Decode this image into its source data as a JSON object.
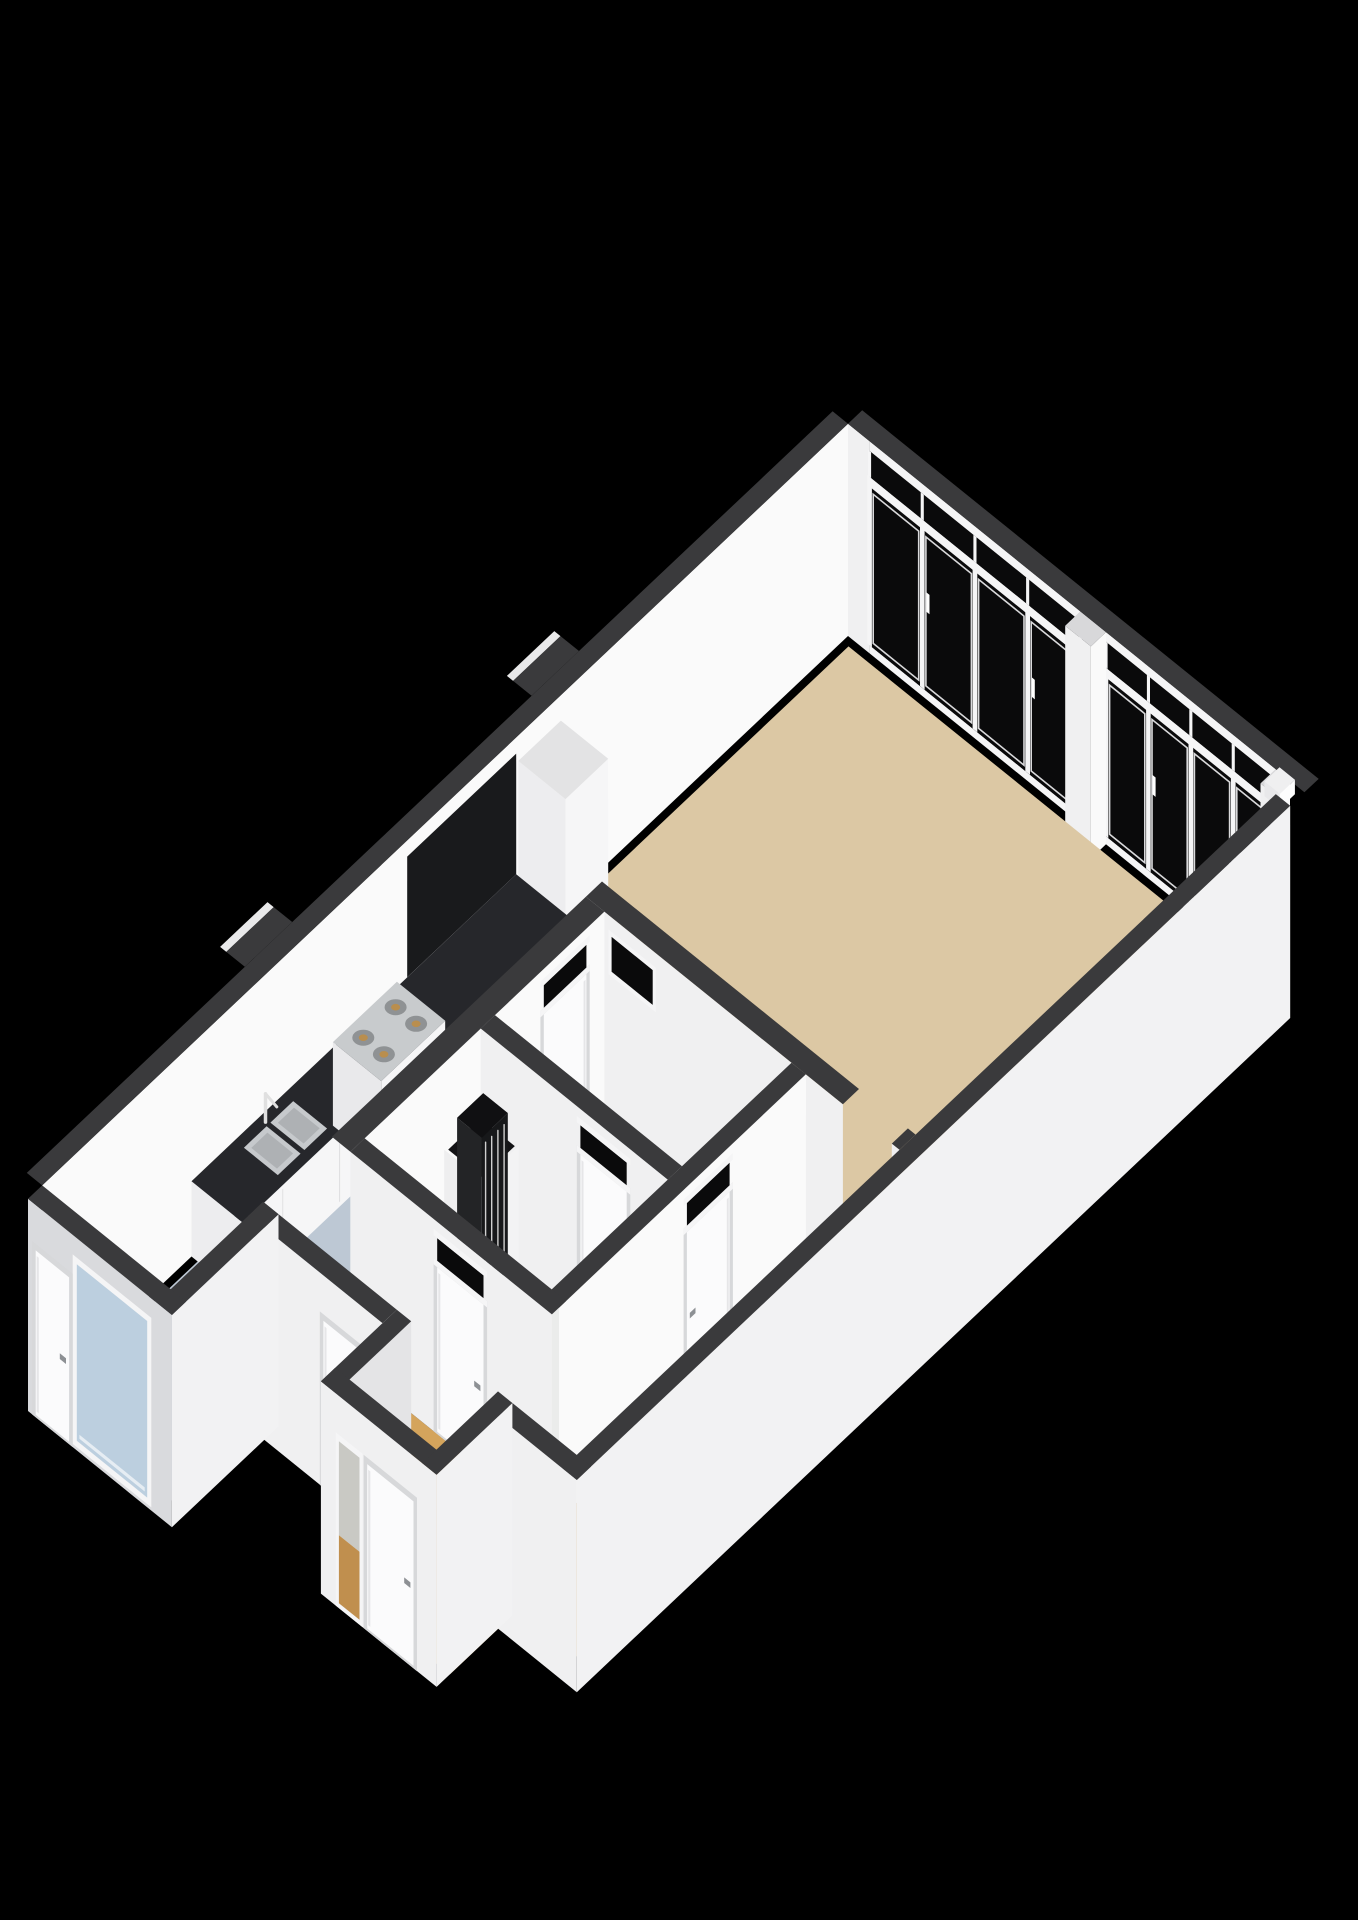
{
  "view": {
    "name": "3d-floorplan-render",
    "description": "Isometric 3D floor plan of an apartment on a black background"
  },
  "scene": {
    "canvas": {
      "width": 1358,
      "height": 1920,
      "background": "#000000"
    },
    "projection": {
      "origin": [
        848,
        636
      ],
      "u": [
        51.4,
        41.5
      ],
      "v": [
        -47.4,
        44.8
      ],
      "z": 81,
      "wallHeight": 2.62
    },
    "colors": {
      "wallTop": "#3a3a3c",
      "wallFaceU": "#fafafa",
      "wallFaceV": "#f0f0f1",
      "wallExtA": "#f2f2f3",
      "wallExtB": "#d9dadd",
      "wallShaded": "#e4e4e6",
      "bumpEdge": "#e9e9ea",
      "floorLiving": "#dcc8a4",
      "floorKitchen": "#bdc8d4",
      "floorHall": "#9aa0a8",
      "floorBath": "#ebeceb",
      "floorCorridor": "#d4a45c",
      "glassDark": "#0a0a0b",
      "glassBlue": "#bccfdf",
      "frame": "#f5f5f6",
      "frameShade": "#d7d8da",
      "paneLine": "#d9d9db",
      "counterTop": "#26272b",
      "counterSeam": "#dedee0",
      "cabinet": "#f6f6f7",
      "cabinetTop": "#e3e3e4",
      "backsplash": "#191a1c",
      "steel": "#c8cbcd",
      "burner": "#8f9294",
      "burnerCenter": "#b98e4e",
      "knob": "#6a6d70",
      "sinkSteel": "#c6c9cc",
      "sinkInner": "#aeb1b4",
      "faucet": "#e0e0e0",
      "radiator": "#1a1b1d",
      "radiatorSlat": "#cfcfcf",
      "shaftDark": "#141416",
      "stepWhite": "#f4f4f5",
      "doorLeaf": "#fbfbfc",
      "doorShade": "#e6e6e8",
      "handle": "#8d9094",
      "sidelightTop": "#c9c9c4",
      "sidelightBottom": "#c08f4e",
      "railing": "#f5f5f6"
    },
    "rooms": [
      {
        "name": "living-room",
        "floorColor": "floorLiving"
      },
      {
        "name": "kitchen",
        "floorColor": "floorKitchen"
      },
      {
        "name": "hall",
        "floorColor": "floorHall"
      },
      {
        "name": "bathroom",
        "floorColor": "floorBath"
      },
      {
        "name": "entrance-corridor",
        "floorColor": "floorCorridor"
      },
      {
        "name": "entry-alcove",
        "floorColor": "floorCorridor"
      }
    ],
    "floors": [
      {
        "name": "living-room-floor",
        "u": [
          0.12,
          8.48
        ],
        "v": [
          0.12,
          7.9
        ],
        "color": "floorLiving"
      },
      {
        "name": "kitchen-floor",
        "u": [
          0.12,
          2.5
        ],
        "v": [
          7.9,
          17.02
        ],
        "color": "floorKitchen"
      },
      {
        "name": "hall-floor",
        "u": [
          2.86,
          6.5
        ],
        "v": [
          8.24,
          10.57
        ],
        "color": "floorHall"
      },
      {
        "name": "bathroom-floor",
        "u": [
          2.86,
          6.5
        ],
        "v": [
          10.85,
          13.32
        ],
        "color": "floorBath"
      },
      {
        "name": "corridor-floor",
        "u": [
          6.78,
          8.48
        ],
        "v": [
          8.24,
          15.07
        ],
        "color": "floorCorridor"
      },
      {
        "name": "south-corridor-floor",
        "u": [
          2.86,
          6.78
        ],
        "v": [
          13.6,
          15.07
        ],
        "color": "floorCorridor"
      },
      {
        "name": "entry-alcove-floor",
        "u": [
          5.1,
          7.35
        ],
        "v": [
          15.05,
          16.37
        ],
        "color": "floorCorridor"
      }
    ],
    "nwWall": {
      "v": [
        0,
        17.0
      ],
      "band": [
        -0.3,
        0
      ],
      "bumps": [
        {
          "v": [
            5.35,
            6.35
          ]
        },
        {
          "v": [
            11.4,
            12.4
          ]
        }
      ]
    },
    "windowWall": {
      "solid": [
        0,
        0.42
      ],
      "banks": [
        {
          "u": [
            0.42,
            4.52
          ],
          "panes": 4
        },
        {
          "u": [
            5.02,
            8.32
          ],
          "panes": 4
        }
      ],
      "pillar": [
        4.52,
        5.02
      ],
      "post": [
        8.32,
        8.6
      ],
      "sill": 0.1,
      "glassTop": 2.06,
      "railTop": 2.18,
      "transomTop": 2.5,
      "headerTop": 2.62,
      "band": [
        -0.3,
        0
      ],
      "cap": {
        "u": [
          8.34,
          8.64
        ],
        "v": [
          -0.06,
          0.26
        ],
        "z": [
          2.44,
          2.62
        ]
      }
    },
    "interiorWalls": [
      {
        "name": "living-divider-wall",
        "axis": "u",
        "at": 7.9,
        "th": 0.34,
        "range": [
          2.5,
          8.6
        ],
        "openings": [
          [
            7.5,
            8.45
          ]
        ],
        "highWindow": {
          "range": [
            3.0,
            3.8
          ],
          "z": [
            1.95,
            2.38
          ]
        }
      },
      {
        "name": "kitchen-hall-wall",
        "axis": "v",
        "at": 2.5,
        "th": 0.36,
        "range": [
          8.24,
          13.6
        ],
        "door": {
          "range": [
            8.62,
            9.52
          ],
          "transom": true
        }
      },
      {
        "name": "hall-bathroom-wall",
        "axis": "u",
        "at": 10.55,
        "th": 0.3,
        "range": [
          2.86,
          6.5
        ],
        "door": {
          "range": [
            4.8,
            5.7
          ],
          "transom": true
        }
      },
      {
        "name": "hall-corridor-wall",
        "axis": "v",
        "at": 6.5,
        "th": 0.28,
        "range": [
          8.24,
          13.45
        ],
        "door": {
          "range": [
            9.85,
            10.75
          ],
          "transom": true
        }
      },
      {
        "name": "bathroom-south-wall",
        "axis": "u",
        "at": 13.3,
        "th": 0.3,
        "range": [
          2.86,
          6.78
        ],
        "door": {
          "range": [
            4.55,
            5.45
          ],
          "transom": true
        }
      }
    ],
    "exteriorWalls": [
      {
        "name": "se-exterior-wall",
        "axis": "v",
        "at": 8.6,
        "th": 0.28,
        "range": [
          0.3,
          15.35
        ],
        "faceColor": "wallExtA"
      },
      {
        "name": "south-wall-west",
        "axis": "u",
        "at": 15.05,
        "th": 0.3,
        "range": [
          2.5,
          5.1
        ],
        "door": {
          "range": [
            3.95,
            4.7
          ]
        },
        "faceColor": "wallFaceV"
      },
      {
        "name": "south-wall-east",
        "axis": "u",
        "at": 15.05,
        "th": 0.3,
        "range": [
          7.35,
          8.88
        ],
        "faceColor": "wallFaceV"
      },
      {
        "name": "alcove-west-wall",
        "axis": "v",
        "at": 5.1,
        "th": 0.28,
        "range": [
          15.05,
          16.65
        ],
        "faceColor": "wallShaded"
      },
      {
        "name": "alcove-front-wall",
        "axis": "u",
        "at": 16.35,
        "th": 0.3,
        "range": [
          5.1,
          7.35
        ],
        "door": {
          "range": [
            6.0,
            6.9
          ]
        },
        "sidelight": {
          "range": [
            5.45,
            5.85
          ]
        },
        "faceColor": "wallFaceV"
      },
      {
        "name": "alcove-east-wall",
        "axis": "v",
        "at": 7.07,
        "th": 0.28,
        "range": [
          15.05,
          16.65
        ],
        "faceColor": "wallExtA"
      },
      {
        "name": "leftwing-se-wall",
        "axis": "v",
        "at": 2.5,
        "th": 0.3,
        "range": [
          15.05,
          17.3
        ],
        "faceColor": "wallExtA"
      },
      {
        "name": "leftwing-sw-wall",
        "axis": "u",
        "at": 17.0,
        "th": 0.3,
        "range": [
          0,
          2.8
        ],
        "door": {
          "range": [
            0.15,
            0.8
          ]
        },
        "window": {
          "range": [
            0.95,
            2.32
          ],
          "z": [
            0.12,
            2.3
          ]
        },
        "faceColor": "wallExtB"
      }
    ],
    "fixtures": {
      "tallCabinet": {
        "u": [
          0.04,
          0.96
        ],
        "v": [
          6.1,
          7.0
        ],
        "h": 2.35
      },
      "backsplash": {
        "v": [
          7.0,
          9.3
        ],
        "z": [
          0.93,
          2.42
        ]
      },
      "counter": {
        "u": [
          0.0,
          1.0
        ],
        "v": [
          7.0,
          13.85
        ],
        "h": 0.93,
        "seams": [
          8.15,
          9.3,
          11.8,
          13.0
        ]
      },
      "stove": {
        "u": [
          0.03,
          0.97
        ],
        "v": [
          9.55,
          10.9
        ],
        "hTop": 1.03,
        "burners": [
          [
            0.3,
            9.87
          ],
          [
            0.7,
            9.87
          ],
          [
            0.3,
            10.55
          ],
          [
            0.7,
            10.55
          ]
        ]
      },
      "sink": {
        "basins": [
          {
            "u": [
              0.18,
              0.84
            ],
            "v": [
              11.9,
              12.38
            ]
          },
          {
            "u": [
              0.18,
              0.84
            ],
            "v": [
              12.46,
              12.94
            ]
          }
        ],
        "faucet": {
          "u": 0.12,
          "v": 12.42
        }
      },
      "railing": {
        "u": 1.98,
        "v": [
          8.35,
          9.3
        ],
        "h": 1.05,
        "balusters": 9
      },
      "heater": {
        "enclosure": {
          "u": [
            2.86,
            3.6
          ],
          "v": [
            10.85,
            11.62
          ],
          "h": 1.55
        },
        "radiator": {
          "u": [
            3.0,
            3.48
          ],
          "v": [
            10.95,
            11.5
          ],
          "h": 1.95
        }
      },
      "steps": [
        {
          "u": [
            7.55,
            8.42
          ],
          "v": [
            7.42,
            7.9
          ],
          "h": 0.17
        },
        {
          "u": [
            7.55,
            8.42
          ],
          "v": [
            7.66,
            7.9
          ],
          "h": 0.34
        },
        {
          "u": [
            7.5,
            8.48
          ],
          "v": [
            8.24,
            8.88
          ],
          "h": 0.52
        }
      ]
    }
  }
}
